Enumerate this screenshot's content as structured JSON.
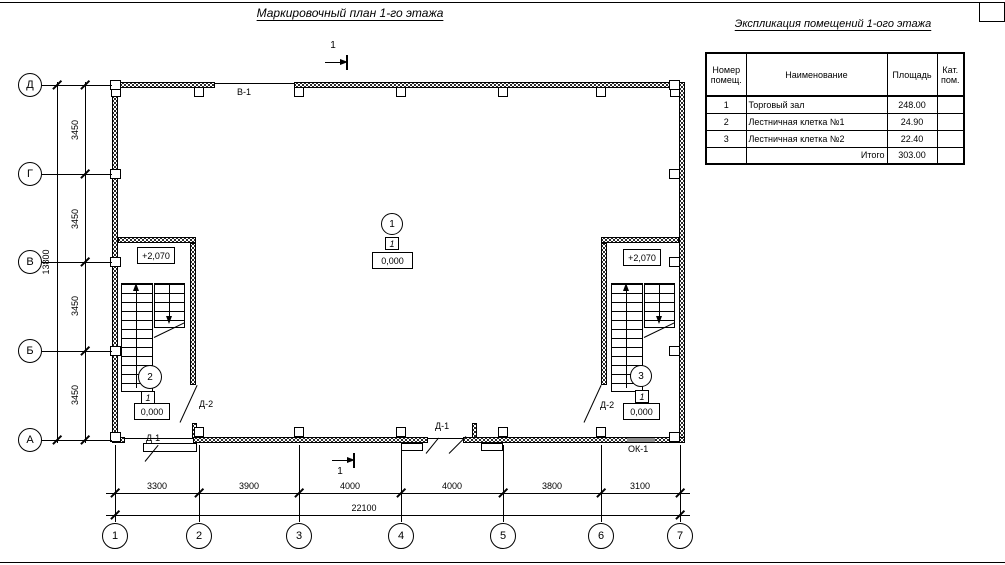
{
  "sheet": {
    "plan_title": "Маркировочный план 1-го этажа",
    "table_title": "Экспликация помещений 1-ого этажа"
  },
  "table": {
    "headers": [
      "Номер помещ.",
      "Наименование",
      "Площадь",
      "Кат. пом."
    ],
    "rows": [
      [
        "1",
        "Торговый зал",
        "248.00",
        ""
      ],
      [
        "2",
        "Лестничная клетка №1",
        "24.90",
        ""
      ],
      [
        "3",
        "Лестничная клетка №2",
        "22.40",
        ""
      ]
    ],
    "total_label": "Итого",
    "total_value": "303.00"
  },
  "axes": {
    "cols": [
      "1",
      "2",
      "3",
      "4",
      "5",
      "6",
      "7"
    ],
    "rows": [
      "Д",
      "Г",
      "В",
      "Б",
      "А"
    ]
  },
  "dims": {
    "bottom_segments": [
      "3300",
      "3900",
      "4000",
      "4000",
      "3800",
      "3100"
    ],
    "bottom_total": "22100",
    "left_segments": [
      "3450",
      "3450",
      "3450",
      "3450"
    ],
    "left_total": "13800"
  },
  "plan": {
    "section_mark": "1",
    "gate_label": "В-1",
    "door1_label": "Д-1",
    "door2_label": "Д-2",
    "window_label": "ОК-1",
    "stair_elevation": "+2,070",
    "rooms": [
      {
        "number": "1",
        "category": "1",
        "elevation": "0,000"
      },
      {
        "number": "2",
        "category": "1",
        "elevation": "0,000"
      },
      {
        "number": "3",
        "category": "1",
        "elevation": "0,000"
      }
    ]
  }
}
